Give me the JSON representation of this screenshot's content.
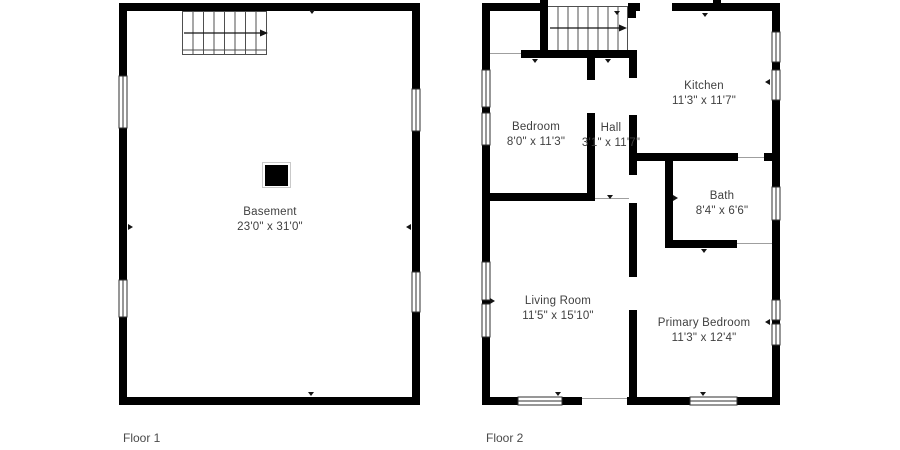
{
  "page": {
    "title": "Floor plans",
    "background": "#ffffff"
  },
  "floors": [
    {
      "label": "Floor 1",
      "rooms": [
        {
          "name": "Basement",
          "dims": "23'0\" x 31'0\""
        }
      ]
    },
    {
      "label": "Floor 2",
      "rooms": [
        {
          "name": "Bedroom",
          "dims": "8'0\" x 11'3\""
        },
        {
          "name": "Hall",
          "dims": "3'1\" x 11'7\""
        },
        {
          "name": "Kitchen",
          "dims": "11'3\" x 11'7\""
        },
        {
          "name": "Bath",
          "dims": "8'4\" x 6'6\""
        },
        {
          "name": "Living Room",
          "dims": "11'5\" x 15'10\""
        },
        {
          "name": "Primary Bedroom",
          "dims": "11'3\" x 12'4\""
        }
      ]
    }
  ],
  "icons": {
    "stairs_icon": "parallel tread lines with direction arrow →",
    "door_marker_icon": "▾ small black triangle",
    "window_icon": "white double-line break in wall",
    "chimney_icon": "■ solid black square"
  },
  "colors": {
    "wall": "#000000",
    "text": "#3f3f3f",
    "floor_label": "#4a4a4a",
    "thin_line": "#9f9f9f",
    "window_stroke": "#2f2f2f",
    "background": "#ffffff"
  }
}
